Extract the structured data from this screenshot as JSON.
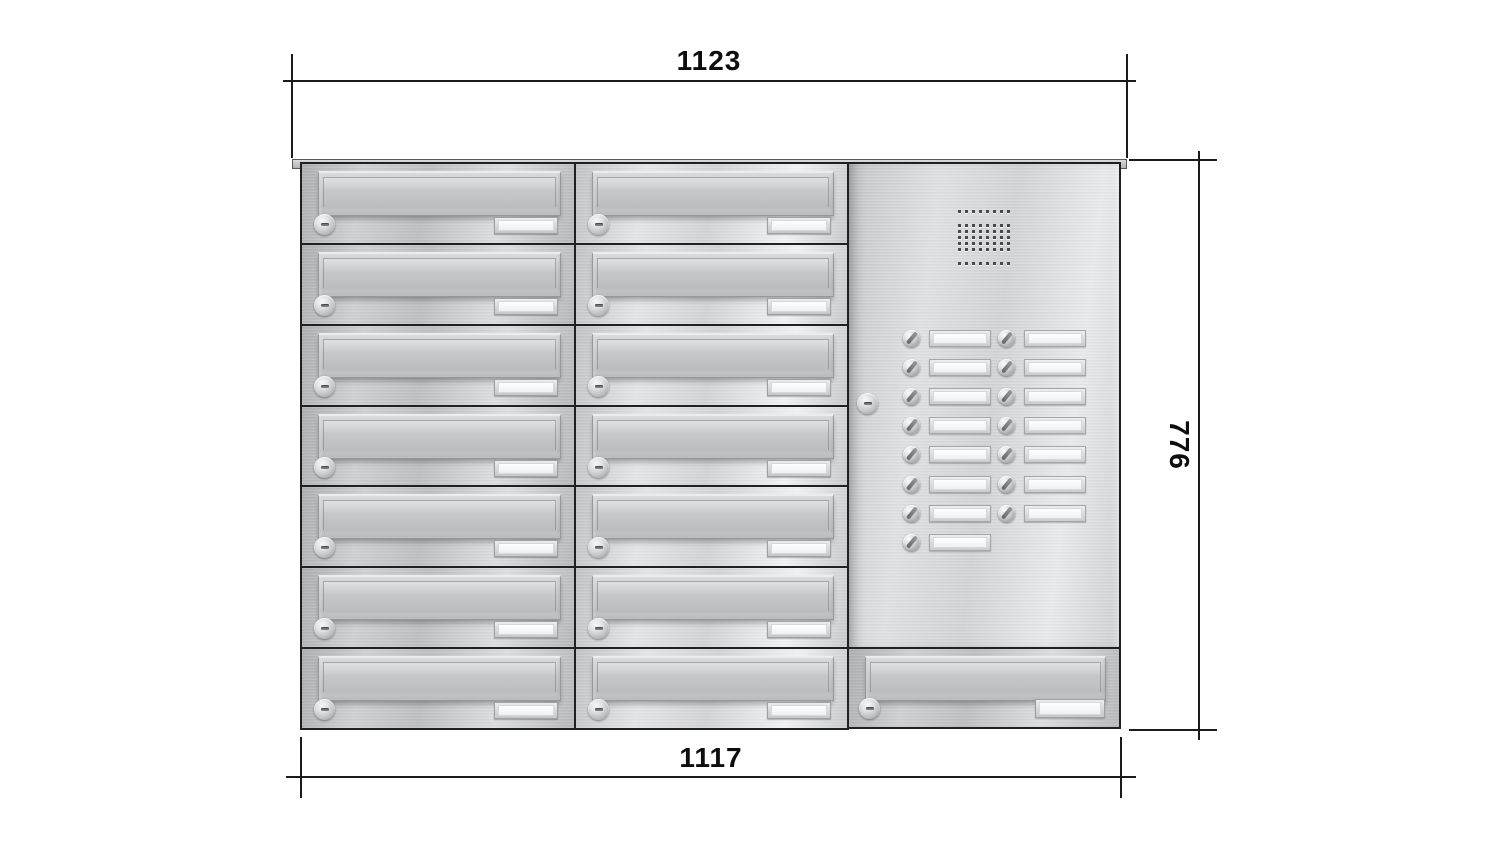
{
  "annotations": {
    "width_top_mm": "1123",
    "width_bottom_mm": "1117",
    "height_mm": "776"
  },
  "unit": {
    "mailbox_columns": 2,
    "mailbox_rows": 7,
    "wide_mailbox_bottom_right": 1,
    "total_mailboxes": 15,
    "intercom_panel": {
      "speaker": "speaker-grille",
      "doorbell_buttons_left_column": 8,
      "doorbell_buttons_right_column": 7,
      "total_doorbell_buttons": 15,
      "lock": "cylinder-lock",
      "nameplates": "blank"
    },
    "colors": {
      "stainless_light": "#e2e3e5",
      "stainless_mid": "#c8c9cb",
      "stainless_dark": "#a9aaac",
      "outline": "#202022",
      "dimension_line": "#1b1b1d",
      "background": "#ffffff"
    }
  }
}
